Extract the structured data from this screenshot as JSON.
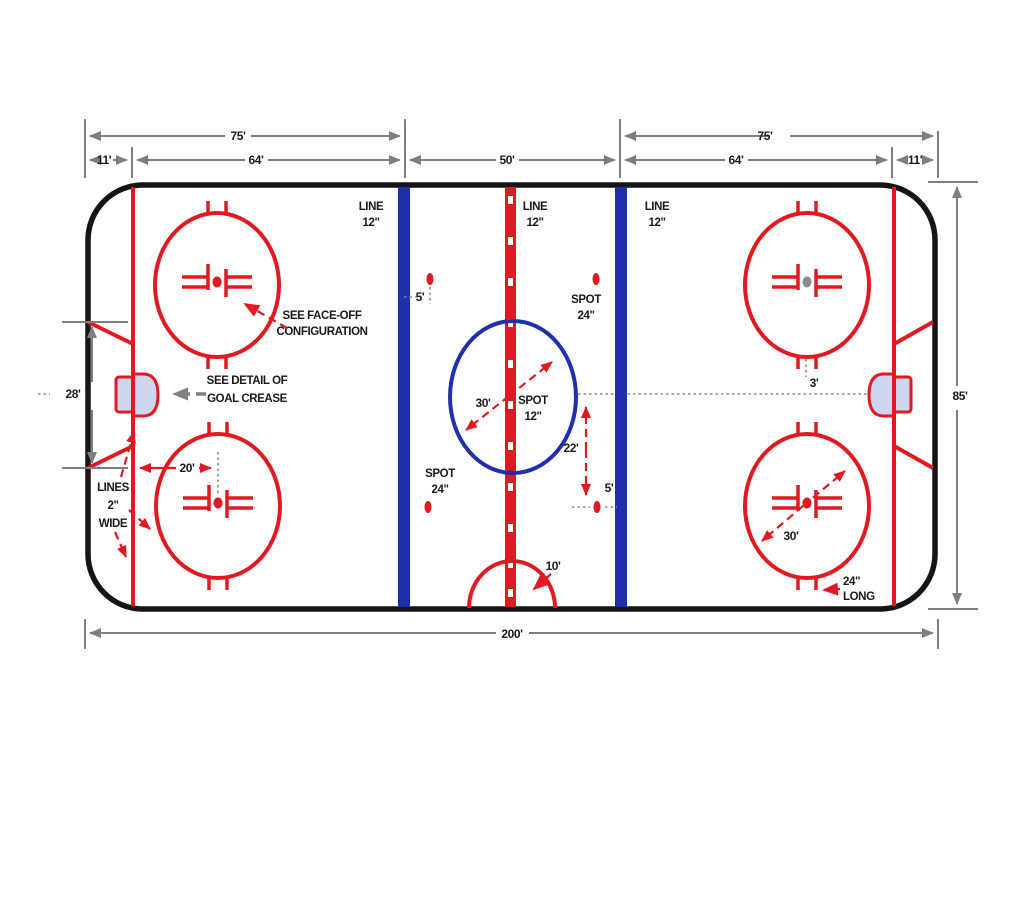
{
  "page": {
    "background": "#ffffff",
    "description": "Ice hockey rink dimension diagram"
  },
  "colors": {
    "red": "#e01a20",
    "blue": "#1f2fae",
    "gray": "#7f7f7f",
    "black": "#1a1a1a",
    "crease_fill": "#ccd7ef"
  },
  "dims": {
    "top_left_75": "75'",
    "top_left_11": "11'",
    "top_left_64": "64'",
    "top_center_50": "50'",
    "top_right_75": "75'",
    "top_right_64": "64'",
    "top_right_11": "11'",
    "right_85": "85'",
    "bottom_200": "200'",
    "left_28": "28'",
    "goal_to_spot_20": "20'",
    "center_circle_30": "30'",
    "right_circle_30": "30'",
    "center_to_spot_22": "22'",
    "blue_to_spot_5_top": "5'",
    "blue_to_spot_5_bottom": "5'",
    "hash_3": "3'",
    "referee_10": "10'"
  },
  "labels": {
    "line12_a": "LINE",
    "line12_b": "12\"",
    "spot24_a": "SPOT",
    "spot24_b": "24\"",
    "spot12_a": "SPOT",
    "spot12_b": "12\"",
    "faceoff_note_a": "SEE FACE-OFF",
    "faceoff_note_b": "CONFIGURATION",
    "crease_note_a": "SEE DETAIL OF",
    "crease_note_b": "GOAL CREASE",
    "lines_note_a": "LINES",
    "lines_note_b": "2\"",
    "lines_note_c": "WIDE",
    "long24_a": "24\"",
    "long24_b": "LONG"
  }
}
